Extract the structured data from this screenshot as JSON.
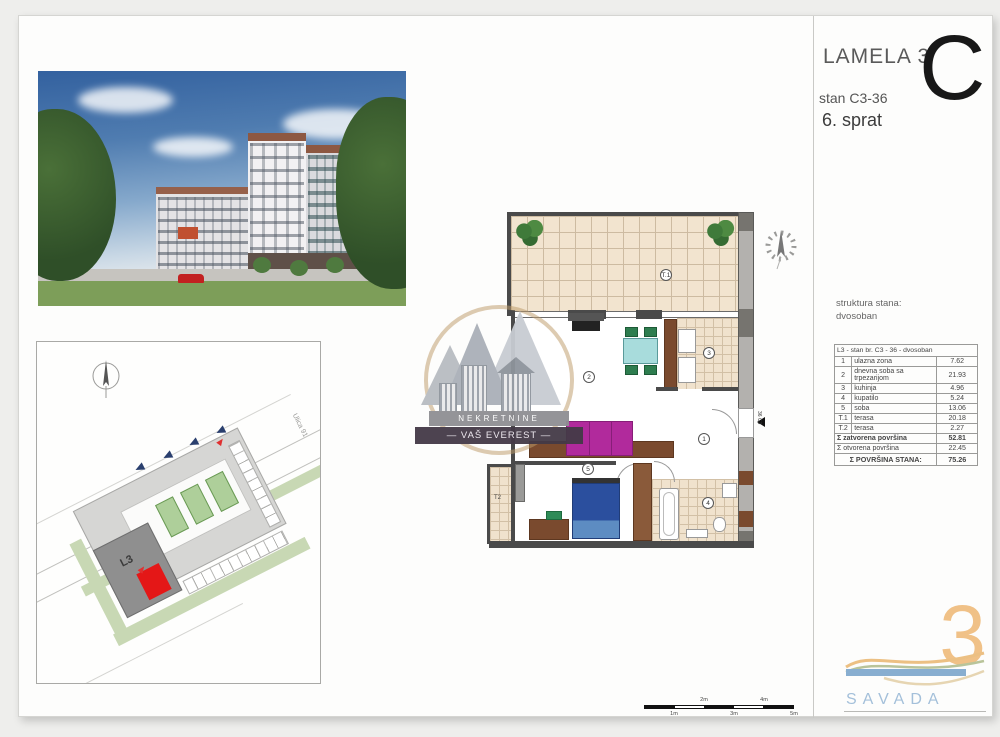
{
  "header": {
    "title": "LAMELA 3",
    "unit": "stan C3-36",
    "floor": "6.  sprat",
    "letter": "C"
  },
  "structure": {
    "label": "struktura stana:",
    "type": "dvosoban"
  },
  "area_table": {
    "title": "L3 - stan br. C3 - 36 - dvosoban",
    "rows": [
      {
        "num": "1",
        "name": "ulazna zona",
        "area": "7.62"
      },
      {
        "num": "2",
        "name": "dnevna soba sa trpezarijom",
        "area": "21.93"
      },
      {
        "num": "3",
        "name": "kuhinja",
        "area": "4.96"
      },
      {
        "num": "4",
        "name": "kupatilo",
        "area": "5.24"
      },
      {
        "num": "5",
        "name": "soba",
        "area": "13.06"
      },
      {
        "num": "T.1",
        "name": "terasa",
        "area": "20.18"
      },
      {
        "num": "T.2",
        "name": "terasa",
        "area": "2.27"
      }
    ],
    "totals": [
      {
        "label": "Σ zatvorena površina",
        "value": "52.81"
      },
      {
        "label": "Σ otvorena površina",
        "value": "22.45"
      },
      {
        "label": "Σ POVRŠINA STANA:",
        "value": "75.26"
      }
    ]
  },
  "floorplan": {
    "room_labels": {
      "terrace1": "T.1",
      "living": "2",
      "kitchen": "3",
      "hall": "1",
      "bath": "4",
      "bedroom": "5",
      "terrace2": "T2"
    },
    "entry_marker": "36 C3"
  },
  "siteplan": {
    "building": "L3",
    "street": "Ulica 91"
  },
  "scalebar": {
    "above": [
      "2m",
      "4m"
    ],
    "below": [
      "1m",
      "3m",
      "5m"
    ]
  },
  "watermark": {
    "line1": "NEKRETNINE",
    "line2": "— VAŠ EVEREST —"
  },
  "brand": {
    "name": "SAVADA",
    "number": "3"
  },
  "colors": {
    "sofa": "#b12a9c",
    "bed": "#2b4f9e",
    "dining_table": "#a8dcdc",
    "chair": "#2e7d4f",
    "terrace_tile": "#f2e4cf",
    "wall": "#4a4a4a",
    "unit_highlight": "#e41717",
    "brand_orange": "#f0c187",
    "brand_blue": "#8fb3d3",
    "site_green": "#c8d8b4"
  }
}
